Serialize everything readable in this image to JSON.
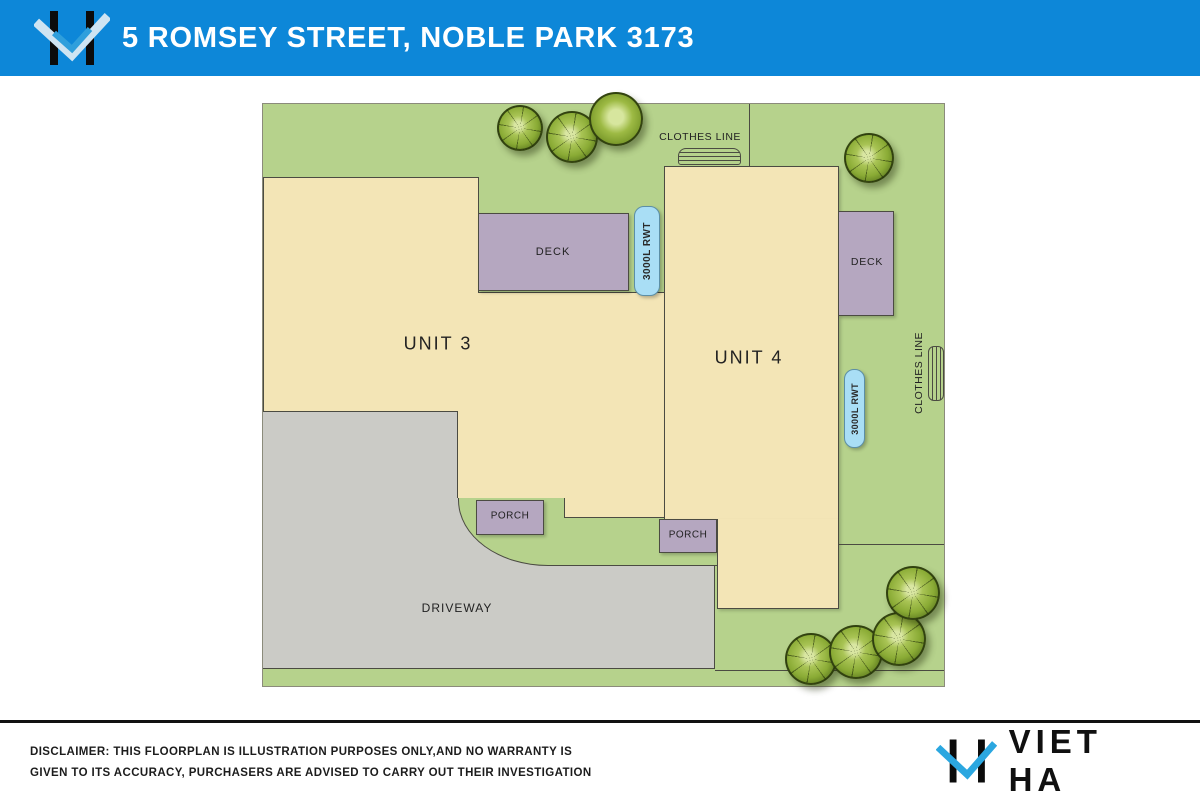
{
  "header": {
    "title": "5 ROMSEY STREET, NOBLE PARK 3173"
  },
  "plan": {
    "unit3_label": "UNIT 3",
    "unit4_label": "UNIT 4",
    "deck1_label": "DECK",
    "deck2_label": "DECK",
    "porch1_label": "PORCH",
    "porch2_label": "PORCH",
    "driveway_label": "DRIVEWAY",
    "clothesline_top_label": "CLOTHES LINE",
    "clothesline_right_label": "CLOTHES LINE",
    "rwt1_label": "3000L RWT",
    "rwt2_label": "3000L RWT"
  },
  "footer": {
    "disclaimer_line1": "DISCLAIMER: THIS FLOORPLAN IS ILLUSTRATION PURPOSES ONLY,AND NO WARRANTY IS",
    "disclaimer_line2": "GIVEN TO ITS ACCURACY, PURCHASERS ARE ADVISED TO CARRY OUT THEIR INVESTIGATION",
    "brand": "VIET HA"
  },
  "colors": {
    "header_blue": "#0d87d8",
    "lawn_green": "#b6d28c",
    "building_cream": "#f3e5b6",
    "deck_purple": "#b5a7c0",
    "driveway_grey": "#cbcbc6",
    "tank_blue": "#a9def5",
    "logo_check_blue": "#2ba7e0"
  }
}
